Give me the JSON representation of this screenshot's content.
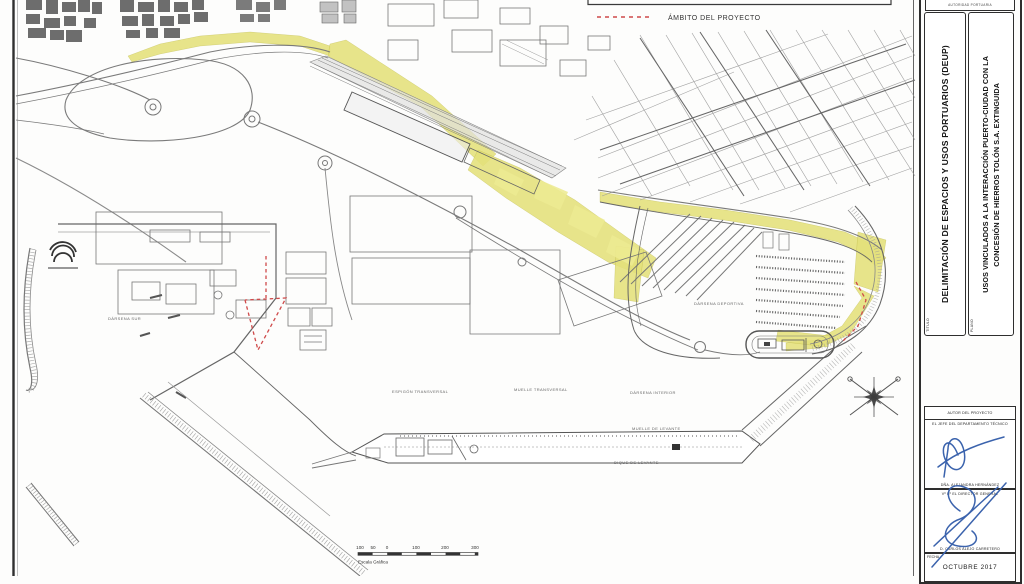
{
  "document": {
    "top_note": "AUTORIDAD PORTUARIA"
  },
  "legend": {
    "ambito": "ÁMBITO DEL PROYECTO"
  },
  "title_block": {
    "titulo_tag": "TÍTULO",
    "titulo_text": "DELIMITACIÓN DE ESPACIOS Y USOS PORTUARIOS (DEUP)",
    "plano_tag": "PLANO",
    "plano_line1": "USOS VINCULADOS A LA INTERACCIÓN PUERTO-CIUDAD CON LA",
    "plano_line2": "CONCESIÓN DE HIERROS TOLÓN S.A. EXTINGUIDA",
    "autor_header": "AUTOR DEL PROYECTO",
    "sign1_role": "EL JEFE DEL DEPARTAMENTO TÉCNICO",
    "sign1_name": "DÑA. ALEJANDRA HERNÁNDEZ",
    "sign2_role": "Vº Bº EL DIRECTOR GENERAL",
    "sign2_name": "D. CARLOS ALEJO CARRETERO",
    "fecha_tag": "FECHA",
    "fecha_value": "OCTUBRE 2017"
  },
  "scale_bar": {
    "ticks": [
      "100",
      "50",
      "0",
      "100",
      "200",
      "300"
    ],
    "caption": "Escala Gráfica"
  },
  "map_labels": [
    {
      "text": "DÁRSENA SUR"
    },
    {
      "text": "ESPIGÓN TRANSVERSAL"
    },
    {
      "text": "MUELLE TRANSVERSAL"
    },
    {
      "text": "DÁRSENA INTERIOR"
    },
    {
      "text": "DÁRSENA DEPORTIVA"
    },
    {
      "text": "MUELLE DE LEVANTE"
    },
    {
      "text": "DIQUE DE LEVANTE"
    }
  ],
  "colors": {
    "highlight_zone": "#e4e07a",
    "project_outline": "#cf4a4a",
    "signature_ink": "#3b63ad"
  }
}
